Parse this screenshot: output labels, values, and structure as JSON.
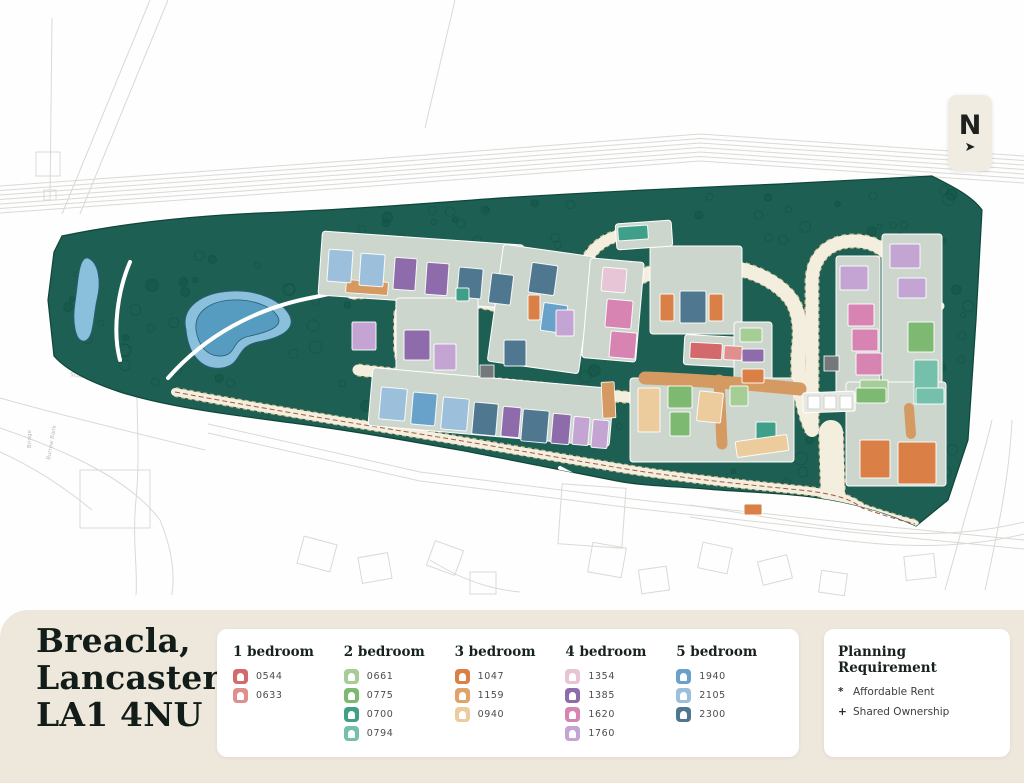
{
  "meta": {
    "title_lines": [
      "Breacla,",
      "Lancaster,",
      "LA1 4NU"
    ]
  },
  "north": {
    "label": "N",
    "arrow": "➤"
  },
  "legend": {
    "groups": [
      {
        "label": "1 bedroom",
        "items": [
          {
            "code": "0544",
            "color": "#d4696b"
          },
          {
            "code": "0633",
            "color": "#de8f8e"
          }
        ]
      },
      {
        "label": "2 bedroom",
        "items": [
          {
            "code": "0661",
            "color": "#a6cd96"
          },
          {
            "code": "0775",
            "color": "#7db971"
          },
          {
            "code": "0700",
            "color": "#3f9f89"
          },
          {
            "code": "0794",
            "color": "#74c0ab"
          }
        ]
      },
      {
        "label": "3 bedroom",
        "items": [
          {
            "code": "1047",
            "color": "#da8046"
          },
          {
            "code": "1159",
            "color": "#dfa368"
          },
          {
            "code": "0940",
            "color": "#eccb9d"
          }
        ]
      },
      {
        "label": "4 bedroom",
        "items": [
          {
            "code": "1354",
            "color": "#e7c4d6"
          },
          {
            "code": "1385",
            "color": "#8e6cab"
          },
          {
            "code": "1620",
            "color": "#d884b3"
          },
          {
            "code": "1760",
            "color": "#c3a4d2"
          }
        ]
      },
      {
        "label": "5 bedroom",
        "items": [
          {
            "code": "1940",
            "color": "#68a2cb"
          },
          {
            "code": "2105",
            "color": "#9cc0dc"
          },
          {
            "code": "2300",
            "color": "#4f7890"
          }
        ]
      }
    ]
  },
  "planning": {
    "title": "Planning Requirement",
    "items": [
      {
        "bullet": "*",
        "label": "Affordable Rent"
      },
      {
        "bullet": "+",
        "label": "Shared Ownership"
      }
    ]
  },
  "map": {
    "colors": {
      "site": "#1d6053",
      "site_edge": "#0f4639",
      "tree": "#0c4a3e",
      "pond_out": "#8ac0dc",
      "pond_in": "#569bc0",
      "pond_edge": "#2a5d74",
      "road": "#f3eedd",
      "road_dash": "#c9b287",
      "terracotta": "#d59a62",
      "pad": "#ccd6cd",
      "garage": "#e7e8e2",
      "context": "#d9d9d4",
      "utility": "#75787a",
      "boundary_dash": "#a25a41"
    },
    "site_path": "M 62 236 C 120 224 190 216 260 213 C 340 210 420 204 500 198 C 580 193 680 188 780 184 L 932 176 C 952 186 972 196 982 210 L 976 320 L 968 440 L 948 500 L 916 526 C 886 512 850 502 812 497 C 770 492 740 492 706 489 C 668 486 640 486 612 480 C 570 472 520 462 470 452 C 420 443 360 432 300 424 C 240 416 170 408 120 392 C 90 382 66 370 54 356 L 48 300 L 54 252 Z",
    "ponds": [
      {
        "outer": "M 88 258 C 98 262 102 280 97 300 C 93 318 94 338 85 341 C 75 343 72 322 75 302 C 78 284 78 256 88 258 Z"
      },
      {
        "outer": "M 186 330 C 180 306 204 292 232 291 C 258 290 282 300 290 316 C 296 330 280 338 258 342 C 234 347 244 364 222 368 C 200 371 188 352 186 330 Z",
        "inner": "M 196 330 C 194 312 210 301 232 300 C 252 299 272 306 278 317 C 283 327 268 332 250 336 C 230 340 238 354 222 356 C 206 357 198 344 196 330 Z"
      }
    ],
    "roads": [
      {
        "d": "M 352 292 C 410 287 455 296 490 303 C 525 310 545 316 565 315 C 592 314 602 296 628 282 C 654 269 692 263 722 266 C 752 269 776 281 790 298 C 799 310 801 328 799 346 C 796 374 801 406 812 430",
        "w": 14
      },
      {
        "d": "M 408 304 L 448 304 C 462 304 468 314 468 330 L 468 348 C 468 364 458 372 442 372 L 424 372 C 408 372 400 362 400 346 L 400 320 C 400 310 402 304 408 304 Z",
        "w": 12
      },
      {
        "d": "M 565 315 C 572 298 578 270 592 252 C 600 242 612 236 628 233 C 640 231 652 230 664 230",
        "w": 11
      },
      {
        "d": "M 812 430 L 812 282 C 812 256 830 240 856 241 C 882 242 897 258 896 284 L 888 432",
        "w": 13
      },
      {
        "d": "M 896 300 C 914 298 928 300 940 306",
        "w": 9
      },
      {
        "d": "M 358 370 C 420 377 480 382 540 388 C 580 392 612 396 645 399",
        "w": 11
      },
      {
        "d": "M 833 497 L 831 432",
        "w": 24
      },
      {
        "d": "M 175 392 C 260 408 340 421 420 434 C 500 447 560 458 620 468 C 680 478 740 484 800 490 C 830 493 850 498 862 508 C 880 514 898 520 915 524",
        "w": 8
      }
    ],
    "white_paths": [
      "M 168 378 C 205 336 255 308 315 297 C 340 292 360 286 375 282",
      "M 375 282 C 395 268 420 260 452 254",
      "M 240 418 C 330 438 430 455 540 468",
      "M 130 262 C 118 290 112 330 120 360",
      "M 560 468 C 600 490 640 500 690 502"
    ],
    "terracotta_roads": [
      {
        "d": "M 645 378 C 700 380 750 384 800 389",
        "w": 13
      },
      {
        "d": "M 719 380 L 722 444",
        "w": 11
      },
      {
        "d": "M 909 408 L 911 434",
        "w": 10
      }
    ],
    "terracotta_blocks": [
      {
        "x": 346,
        "y": 281,
        "w": 42,
        "h": 13,
        "rot": 4
      },
      {
        "x": 602,
        "y": 382,
        "w": 13,
        "h": 36,
        "rot": -3
      }
    ],
    "pads": [
      {
        "x": 320,
        "y": 238,
        "w": 202,
        "h": 64,
        "rot": 4
      },
      {
        "x": 396,
        "y": 298,
        "w": 82,
        "h": 80,
        "rot": 0
      },
      {
        "x": 495,
        "y": 250,
        "w": 92,
        "h": 118,
        "rot": 8
      },
      {
        "x": 586,
        "y": 260,
        "w": 54,
        "h": 100,
        "rot": 5
      },
      {
        "x": 650,
        "y": 246,
        "w": 92,
        "h": 88,
        "rot": 0
      },
      {
        "x": 684,
        "y": 336,
        "w": 58,
        "h": 30,
        "rot": 3
      },
      {
        "x": 734,
        "y": 322,
        "w": 38,
        "h": 68,
        "rot": 0
      },
      {
        "x": 836,
        "y": 256,
        "w": 44,
        "h": 154,
        "rot": 0
      },
      {
        "x": 882,
        "y": 234,
        "w": 60,
        "h": 180,
        "rot": 0
      },
      {
        "x": 846,
        "y": 382,
        "w": 100,
        "h": 104,
        "rot": 0
      },
      {
        "x": 370,
        "y": 378,
        "w": 242,
        "h": 58,
        "rot": 5
      },
      {
        "x": 630,
        "y": 378,
        "w": 164,
        "h": 84,
        "rot": 0
      },
      {
        "x": 616,
        "y": 222,
        "w": 56,
        "h": 26,
        "rot": -4
      }
    ],
    "garage_block": {
      "x": 803,
      "y": 392,
      "w": 52,
      "h": 20,
      "rot": -2,
      "doors": [
        {
          "x": 808,
          "y": 396
        },
        {
          "x": 824,
          "y": 396
        },
        {
          "x": 840,
          "y": 396
        }
      ]
    },
    "houses": [
      {
        "x": 328,
        "y": 250,
        "w": 24,
        "h": 32,
        "rot": 4,
        "code": "2105"
      },
      {
        "x": 360,
        "y": 254,
        "w": 24,
        "h": 32,
        "rot": 4,
        "code": "2105"
      },
      {
        "x": 394,
        "y": 258,
        "w": 22,
        "h": 32,
        "rot": 4,
        "code": "1385"
      },
      {
        "x": 426,
        "y": 263,
        "w": 22,
        "h": 32,
        "rot": 4,
        "code": "1385"
      },
      {
        "x": 458,
        "y": 268,
        "w": 24,
        "h": 30,
        "rot": 5,
        "code": "2300"
      },
      {
        "x": 490,
        "y": 274,
        "w": 22,
        "h": 30,
        "rot": 7,
        "code": "2300"
      },
      {
        "x": 352,
        "y": 322,
        "w": 24,
        "h": 28,
        "rot": 0,
        "code": "1760"
      },
      {
        "x": 404,
        "y": 330,
        "w": 26,
        "h": 30,
        "rot": 0,
        "code": "1385"
      },
      {
        "x": 434,
        "y": 344,
        "w": 22,
        "h": 26,
        "rot": 0,
        "code": "1760"
      },
      {
        "x": 530,
        "y": 264,
        "w": 26,
        "h": 30,
        "rot": 8,
        "code": "2300"
      },
      {
        "x": 542,
        "y": 304,
        "w": 24,
        "h": 28,
        "rot": 8,
        "code": "1940"
      },
      {
        "x": 504,
        "y": 340,
        "w": 22,
        "h": 26,
        "rot": 0,
        "code": "2300"
      },
      {
        "x": 556,
        "y": 310,
        "w": 18,
        "h": 26,
        "rot": 0,
        "code": "1760"
      },
      {
        "x": 528,
        "y": 295,
        "w": 12,
        "h": 25,
        "rot": 0,
        "code": "1047"
      },
      {
        "x": 456,
        "y": 288,
        "w": 13,
        "h": 13,
        "rot": 0,
        "code": "0700"
      },
      {
        "x": 602,
        "y": 268,
        "w": 24,
        "h": 24,
        "rot": 5,
        "code": "1354"
      },
      {
        "x": 606,
        "y": 300,
        "w": 26,
        "h": 28,
        "rot": 5,
        "code": "1620"
      },
      {
        "x": 610,
        "y": 332,
        "w": 26,
        "h": 26,
        "rot": 5,
        "code": "1620"
      },
      {
        "x": 618,
        "y": 226,
        "w": 30,
        "h": 14,
        "rot": -4,
        "code": "0700"
      },
      {
        "x": 660,
        "y": 294,
        "w": 14,
        "h": 27,
        "rot": 0,
        "code": "1047"
      },
      {
        "x": 680,
        "y": 291,
        "w": 26,
        "h": 32,
        "rot": 0,
        "code": "2300"
      },
      {
        "x": 709,
        "y": 294,
        "w": 14,
        "h": 27,
        "rot": 0,
        "code": "1047"
      },
      {
        "x": 690,
        "y": 343,
        "w": 32,
        "h": 16,
        "rot": 3,
        "code": "0544"
      },
      {
        "x": 724,
        "y": 346,
        "w": 18,
        "h": 14,
        "rot": 3,
        "code": "0633"
      },
      {
        "x": 740,
        "y": 328,
        "w": 22,
        "h": 14,
        "rot": 0,
        "code": "0661"
      },
      {
        "x": 742,
        "y": 349,
        "w": 22,
        "h": 13,
        "rot": 0,
        "code": "1385"
      },
      {
        "x": 742,
        "y": 369,
        "w": 22,
        "h": 14,
        "rot": 0,
        "code": "1047"
      },
      {
        "x": 840,
        "y": 266,
        "w": 28,
        "h": 24,
        "rot": 0,
        "code": "1760"
      },
      {
        "x": 890,
        "y": 244,
        "w": 30,
        "h": 24,
        "rot": 0,
        "code": "1760"
      },
      {
        "x": 898,
        "y": 278,
        "w": 28,
        "h": 20,
        "rot": 0,
        "code": "1760"
      },
      {
        "x": 848,
        "y": 304,
        "w": 26,
        "h": 22,
        "rot": 0,
        "code": "1620"
      },
      {
        "x": 852,
        "y": 329,
        "w": 26,
        "h": 22,
        "rot": 0,
        "code": "1620"
      },
      {
        "x": 856,
        "y": 353,
        "w": 26,
        "h": 22,
        "rot": 0,
        "code": "1620"
      },
      {
        "x": 860,
        "y": 380,
        "w": 28,
        "h": 22,
        "rot": 0,
        "code": "0661"
      },
      {
        "x": 908,
        "y": 322,
        "w": 26,
        "h": 30,
        "rot": 0,
        "code": "0775"
      },
      {
        "x": 914,
        "y": 360,
        "w": 24,
        "h": 44,
        "rot": 0,
        "code": "0794"
      },
      {
        "x": 856,
        "y": 388,
        "w": 30,
        "h": 15,
        "rot": 0,
        "code": "0775"
      },
      {
        "x": 916,
        "y": 388,
        "w": 28,
        "h": 16,
        "rot": 0,
        "code": "0794"
      },
      {
        "x": 860,
        "y": 440,
        "w": 30,
        "h": 38,
        "rot": 0,
        "code": "1047"
      },
      {
        "x": 898,
        "y": 442,
        "w": 38,
        "h": 42,
        "rot": 0,
        "code": "1047"
      },
      {
        "x": 380,
        "y": 388,
        "w": 26,
        "h": 32,
        "rot": 5,
        "code": "2105"
      },
      {
        "x": 412,
        "y": 393,
        "w": 24,
        "h": 32,
        "rot": 5,
        "code": "1940"
      },
      {
        "x": 442,
        "y": 398,
        "w": 26,
        "h": 32,
        "rot": 5,
        "code": "2105"
      },
      {
        "x": 473,
        "y": 403,
        "w": 24,
        "h": 32,
        "rot": 5,
        "code": "2300"
      },
      {
        "x": 502,
        "y": 407,
        "w": 18,
        "h": 30,
        "rot": 5,
        "code": "1385"
      },
      {
        "x": 522,
        "y": 410,
        "w": 26,
        "h": 32,
        "rot": 5,
        "code": "2300"
      },
      {
        "x": 552,
        "y": 414,
        "w": 18,
        "h": 30,
        "rot": 5,
        "code": "1385"
      },
      {
        "x": 573,
        "y": 417,
        "w": 16,
        "h": 28,
        "rot": 5,
        "code": "1760"
      },
      {
        "x": 592,
        "y": 420,
        "w": 16,
        "h": 28,
        "rot": 5,
        "code": "1760"
      },
      {
        "x": 638,
        "y": 388,
        "w": 22,
        "h": 44,
        "rot": 0,
        "code": "0940"
      },
      {
        "x": 668,
        "y": 386,
        "w": 24,
        "h": 22,
        "rot": 0,
        "code": "0775"
      },
      {
        "x": 670,
        "y": 412,
        "w": 20,
        "h": 24,
        "rot": 0,
        "code": "0775"
      },
      {
        "x": 698,
        "y": 392,
        "w": 24,
        "h": 30,
        "rot": 6,
        "code": "0940"
      },
      {
        "x": 730,
        "y": 386,
        "w": 18,
        "h": 20,
        "rot": 0,
        "code": "0661"
      },
      {
        "x": 756,
        "y": 422,
        "w": 20,
        "h": 18,
        "rot": 0,
        "code": "0700"
      },
      {
        "x": 736,
        "y": 438,
        "w": 52,
        "h": 16,
        "rot": -8,
        "code": "0940"
      },
      {
        "x": 744,
        "y": 504,
        "w": 18,
        "h": 11,
        "rot": 0,
        "code": "1047"
      }
    ],
    "utilities": [
      {
        "x": 480,
        "y": 365,
        "w": 14,
        "h": 13
      },
      {
        "x": 824,
        "y": 356,
        "w": 15,
        "h": 15
      }
    ],
    "tree_regions": [
      [
        60,
        245,
        300,
        150,
        42
      ],
      [
        360,
        195,
        560,
        52,
        34
      ],
      [
        200,
        400,
        620,
        95,
        26
      ],
      [
        930,
        185,
        46,
        230,
        12
      ],
      [
        545,
        330,
        100,
        55,
        7
      ],
      [
        938,
        440,
        38,
        80,
        6
      ]
    ],
    "context": {
      "rail": {
        "pts": [
          [
            0,
            186
          ],
          [
            360,
            160
          ],
          [
            700,
            134
          ],
          [
            1024,
            156
          ]
        ],
        "count": 7,
        "gap": 4.5
      },
      "lines": [
        "M 150 0 L 62 214",
        "M 168 0 L 80 214",
        "M 52 18 L 50 200",
        "M 455 0 L 425 128",
        "M 0 398 C 60 415 130 432 205 450",
        "M 0 428 C 70 452 130 480 160 520",
        "M 160 520 C 172 550 175 572 172 595",
        "M 140 330 C 132 380 142 440 136 500 C 132 540 138 570 136 595",
        "M 208 424 L 420 472 L 640 500 L 860 524 L 1024 540",
        "M 208 433 L 420 481 L 640 509 L 860 533 L 1024 549",
        "M 690 505 C 820 525 920 548 1024 522",
        "M 690 517 C 820 537 920 560 1024 534",
        "M 945 590 C 975 480 986 448 992 420",
        "M 985 590 C 1005 500 1010 460 1012 420",
        "M 430 560 C 470 585 500 590 520 592",
        "M 0 452 C 40 470 70 492 92 510"
      ],
      "rects": [
        {
          "x": 36,
          "y": 152,
          "w": 24,
          "h": 24,
          "rot": 0
        },
        {
          "x": 44,
          "y": 190,
          "w": 12,
          "h": 10,
          "rot": 0
        },
        {
          "x": 300,
          "y": 540,
          "w": 34,
          "h": 28,
          "rot": 15
        },
        {
          "x": 360,
          "y": 555,
          "w": 30,
          "h": 26,
          "rot": -10
        },
        {
          "x": 430,
          "y": 545,
          "w": 30,
          "h": 26,
          "rot": 20
        },
        {
          "x": 470,
          "y": 572,
          "w": 26,
          "h": 22,
          "rot": 0
        },
        {
          "x": 590,
          "y": 545,
          "w": 34,
          "h": 30,
          "rot": 10
        },
        {
          "x": 640,
          "y": 568,
          "w": 28,
          "h": 24,
          "rot": -8
        },
        {
          "x": 700,
          "y": 545,
          "w": 30,
          "h": 26,
          "rot": 12
        },
        {
          "x": 760,
          "y": 558,
          "w": 30,
          "h": 24,
          "rot": -14
        },
        {
          "x": 820,
          "y": 572,
          "w": 26,
          "h": 22,
          "rot": 8
        },
        {
          "x": 905,
          "y": 555,
          "w": 30,
          "h": 24,
          "rot": -6
        },
        {
          "x": 80,
          "y": 470,
          "w": 70,
          "h": 58,
          "rot": 0
        },
        {
          "x": 560,
          "y": 486,
          "w": 64,
          "h": 60,
          "rot": 4
        }
      ],
      "labels": [
        {
          "text": "Bridge",
          "x": 31,
          "y": 448,
          "rot": -90
        },
        {
          "text": "Burrow Bank",
          "x": 50,
          "y": 460,
          "rot": -80
        },
        {
          "text": "Scotforth Road",
          "x": 70,
          "y": 376,
          "rot": 9
        }
      ]
    }
  }
}
